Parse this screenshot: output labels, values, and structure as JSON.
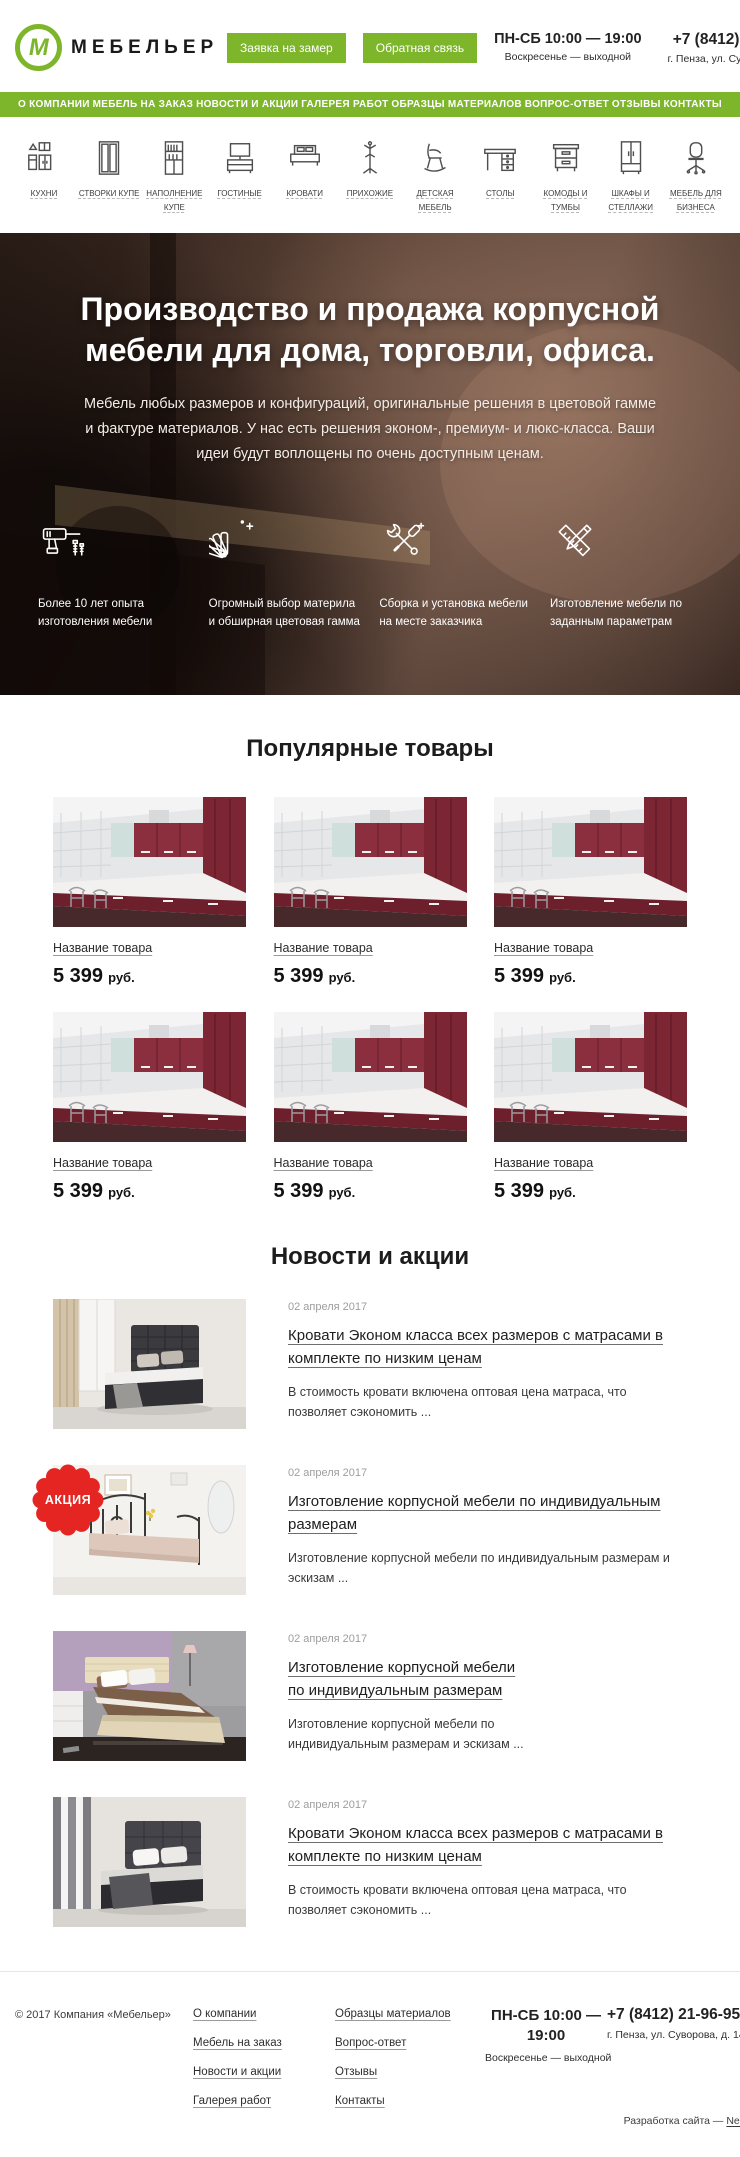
{
  "colors": {
    "accent": "#7eb62b",
    "badge_red": "#e42522"
  },
  "header": {
    "logo_letter": "М",
    "logo_text": "МЕБЕЛЬЕР",
    "buttons": [
      {
        "label": "Заявка на замер"
      },
      {
        "label": "Обратная связь"
      }
    ],
    "hours_line1": "ПН-СБ 10:00 — 19:00",
    "hours_line2": "Воскресенье — выходной",
    "phone": "+7 (8412) 21-96-95",
    "address": "г. Пенза, ул. Суворова, д. 148"
  },
  "nav": {
    "items": [
      "О КОМПАНИИ",
      "МЕБЕЛЬ НА ЗАКАЗ",
      "НОВОСТИ И АКЦИИ",
      "ГАЛЕРЕЯ РАБОТ",
      "ОБРАЗЦЫ МАТЕРИАЛОВ",
      "ВОПРОС-ОТВЕТ",
      "ОТЗЫВЫ",
      "КОНТАКТЫ"
    ]
  },
  "categories": [
    {
      "label": "КУХНИ",
      "icon": "kitchen-icon"
    },
    {
      "label": "СТВОРКИ КУПЕ",
      "icon": "sliding-doors-icon"
    },
    {
      "label": "НАПОЛНЕНИЕ КУПЕ",
      "icon": "wardrobe-fill-icon"
    },
    {
      "label": "ГОСТИНЫЕ",
      "icon": "living-room-icon"
    },
    {
      "label": "КРОВАТИ",
      "icon": "bed-icon"
    },
    {
      "label": "ПРИХОЖИЕ",
      "icon": "coat-rack-icon"
    },
    {
      "label": "ДЕТСКАЯ МЕБЕЛЬ",
      "icon": "kids-furniture-icon"
    },
    {
      "label": "СТОЛЫ",
      "icon": "desk-icon"
    },
    {
      "label": "КОМОДЫ И ТУМБЫ",
      "icon": "drawers-icon"
    },
    {
      "label": "ШКАФЫ И СТЕЛЛАЖИ",
      "icon": "wardrobe-icon"
    },
    {
      "label": "МЕБЕЛЬ ДЛЯ БИЗНЕСА",
      "icon": "office-chair-icon"
    }
  ],
  "hero": {
    "title": "Производство и продажа корпусной мебели для дома, торговли, офиса.",
    "subtitle": "Мебель любых размеров и конфигураций, оригинальные решения в цветовой гамме и фактуре материалов. У нас есть решения эконом-, премиум- и люкс-класса. Ваши идеи будут воплощены по очень доступным ценам.",
    "features": [
      {
        "icon": "drill-icon",
        "text": "Более 10 лет опыта изготовления мебели"
      },
      {
        "icon": "color-fan-icon",
        "text": "Огромный выбор材 материла и обширная цветовая гамма"
      },
      {
        "icon": "tools-icon",
        "text": "Сборка и установка мебели на месте заказчика"
      },
      {
        "icon": "drafting-icon",
        "text": "Изготовление мебели по заданным параметрам"
      }
    ]
  },
  "products": {
    "heading": "Популярные товары",
    "items": [
      {
        "name": "Название товара",
        "price": "5 399",
        "currency": "руб.",
        "image": "kitchen-scene-image"
      },
      {
        "name": "Название товара",
        "price": "5 399",
        "currency": "руб.",
        "image": "kitchen-scene-image"
      },
      {
        "name": "Название товара",
        "price": "5 399",
        "currency": "руб.",
        "image": "kitchen-scene-image"
      },
      {
        "name": "Название товара",
        "price": "5 399",
        "currency": "руб.",
        "image": "kitchen-scene-image"
      },
      {
        "name": "Название товара",
        "price": "5 399",
        "currency": "руб.",
        "image": "kitchen-scene-image"
      },
      {
        "name": "Название товара",
        "price": "5 399",
        "currency": "руб.",
        "image": "kitchen-scene-image"
      }
    ]
  },
  "news": {
    "heading": "Новости и акции",
    "items": [
      {
        "date": "02 апреля 2017",
        "title": "Кровати Эконом класса всех размеров с матрасами в комплекте по низким ценам",
        "text": "В стоимость кровати включена оптовая цена матраса, что позволяет сэкономить ...",
        "image": "bed-dark-image",
        "badge": "",
        "variant": ""
      },
      {
        "date": "02 апреля 2017",
        "title": "Изготовление корпусной мебели по индивидуальным размерам",
        "text": "Изготовление корпусной мебели по индивидуальным размерам и эскизам ...",
        "image": "bed-metal-promo-image",
        "badge": "АКЦИЯ",
        "variant": ""
      },
      {
        "date": "02 апреля 2017",
        "title": "Изготовление корпусной мебели по индивидуальным размерам",
        "text": "Изготовление корпусной мебели по индивидуальным размерам и эскизам ...",
        "image": "bed-wood-image",
        "badge": "",
        "variant": "narrow"
      },
      {
        "date": "02 апреля 2017",
        "title": "Кровати Эконом класса всех размеров с матрасами в комплекте по низким ценам",
        "text": "В стоимость кровати включена оптовая цена матраса, что позволяет сэкономить ...",
        "image": "bed-dark2-image",
        "badge": "",
        "variant": ""
      }
    ]
  },
  "footer": {
    "copyright": "© 2017 Компания «Мебельер»",
    "links_col1": [
      "О компании",
      "Мебель на заказ",
      "Новости и акции",
      "Галерея работ"
    ],
    "links_col2": [
      "Образцы материалов",
      "Вопрос-ответ",
      "Отзывы",
      "Контакты"
    ],
    "hours_line1": "ПН-СБ 10:00 — 19:00",
    "hours_line2": "Воскресенье — выходной",
    "phone": "+7 (8412) 21-96-95",
    "address": "г. Пенза, ул. Суворова, д. 148",
    "credits_prefix": "Разработка сайта — ",
    "credits_link": "Netriks"
  }
}
